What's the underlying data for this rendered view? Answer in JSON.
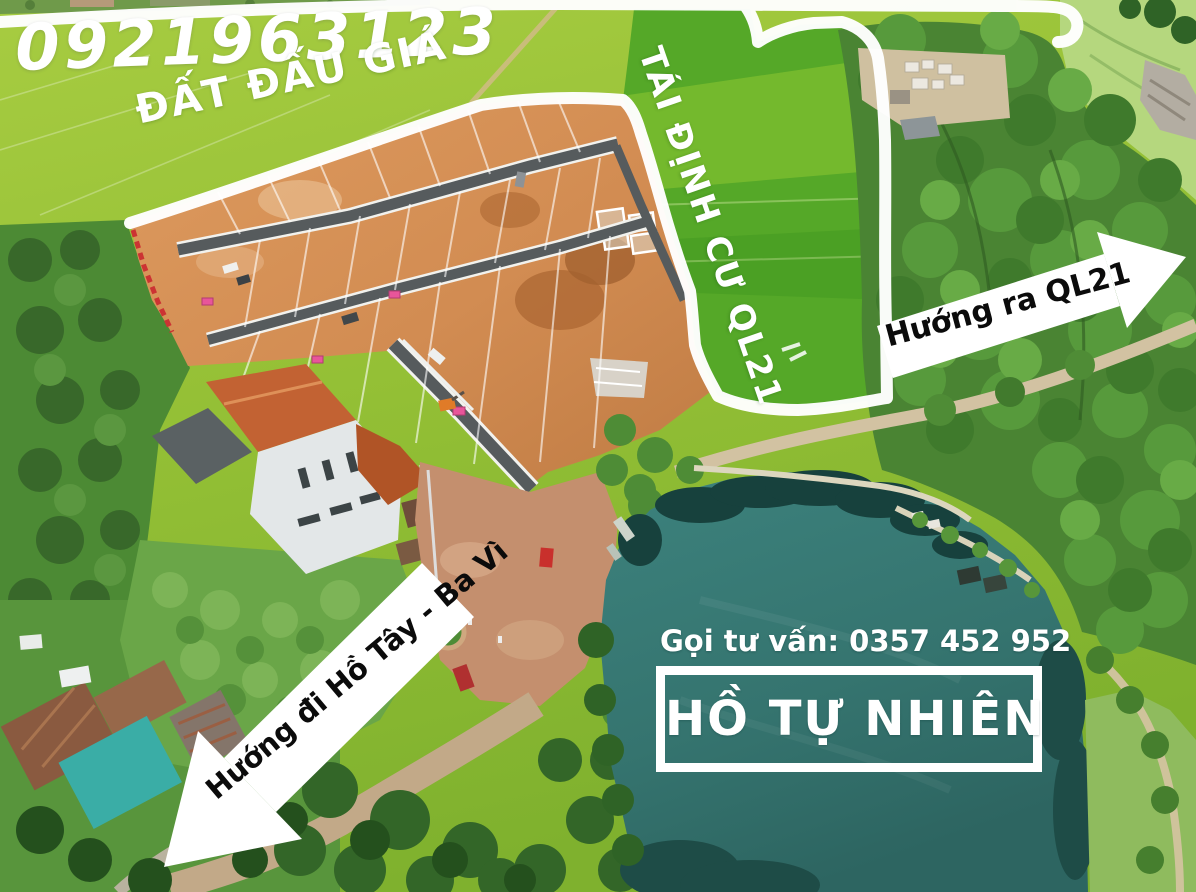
{
  "annotations": {
    "phone_number": "0921963123",
    "auction_area_label": "ĐẤT ĐẤU GIÁ",
    "resettlement_label": "TÁI ĐỊNH CƯ QL21",
    "direction_to_ql21": "Hướng ra QL21",
    "consultation": "Gọi tư vấn: 0357 452 952",
    "lake_label": "HỒ TỰ NHIÊN",
    "direction_to_hotay": "Hướng đi Hồ Tây - Ba Vì"
  },
  "colors": {
    "overlay_text": "#ffffff",
    "arrow_text": "#0b0b0b",
    "boundary_outline": "#ffffff",
    "rice_field": "#9cc43c",
    "resettlement_field": "#55a828",
    "auction_dirt": "#d28c52",
    "lake_water": "#3c7f7a",
    "forest": "#4a8433"
  }
}
